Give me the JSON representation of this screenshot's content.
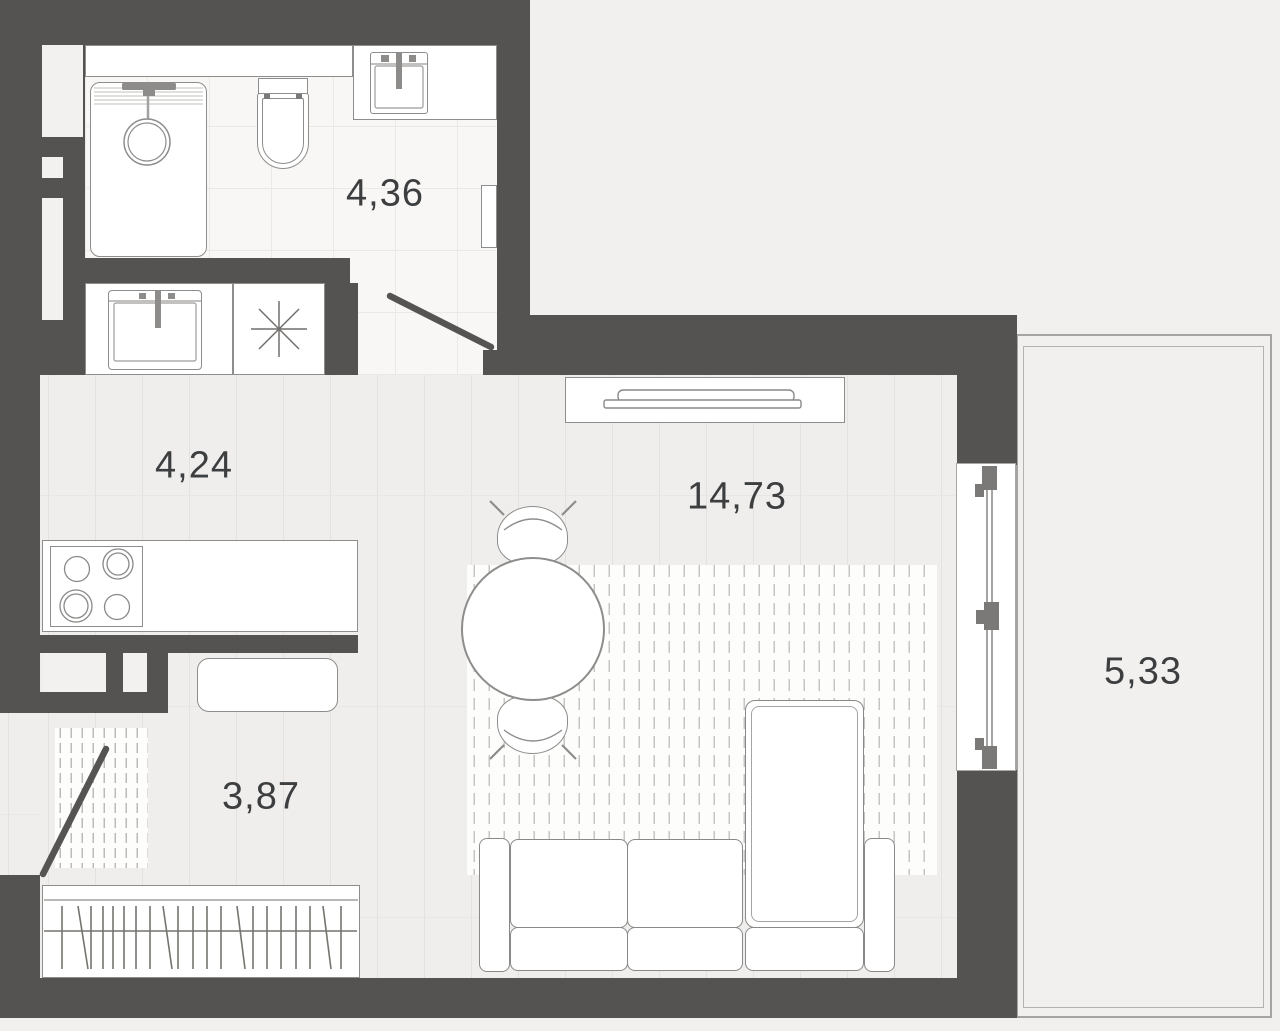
{
  "rooms": {
    "bathroom": {
      "label": "4,36"
    },
    "kitchen": {
      "label": "4,24"
    },
    "living": {
      "label": "14,73"
    },
    "hall": {
      "label": "3,87"
    },
    "balcony": {
      "label": "5,33"
    }
  },
  "colors": {
    "wall": "#555351",
    "background_outside": "#f1f0ef",
    "floor_plank": "#efeeec",
    "floor_tile": "#f8f7f5",
    "fixture_fill": "#ffffff",
    "fixture_border": "#8e8d8b",
    "label_text": "#3d3e3f"
  }
}
